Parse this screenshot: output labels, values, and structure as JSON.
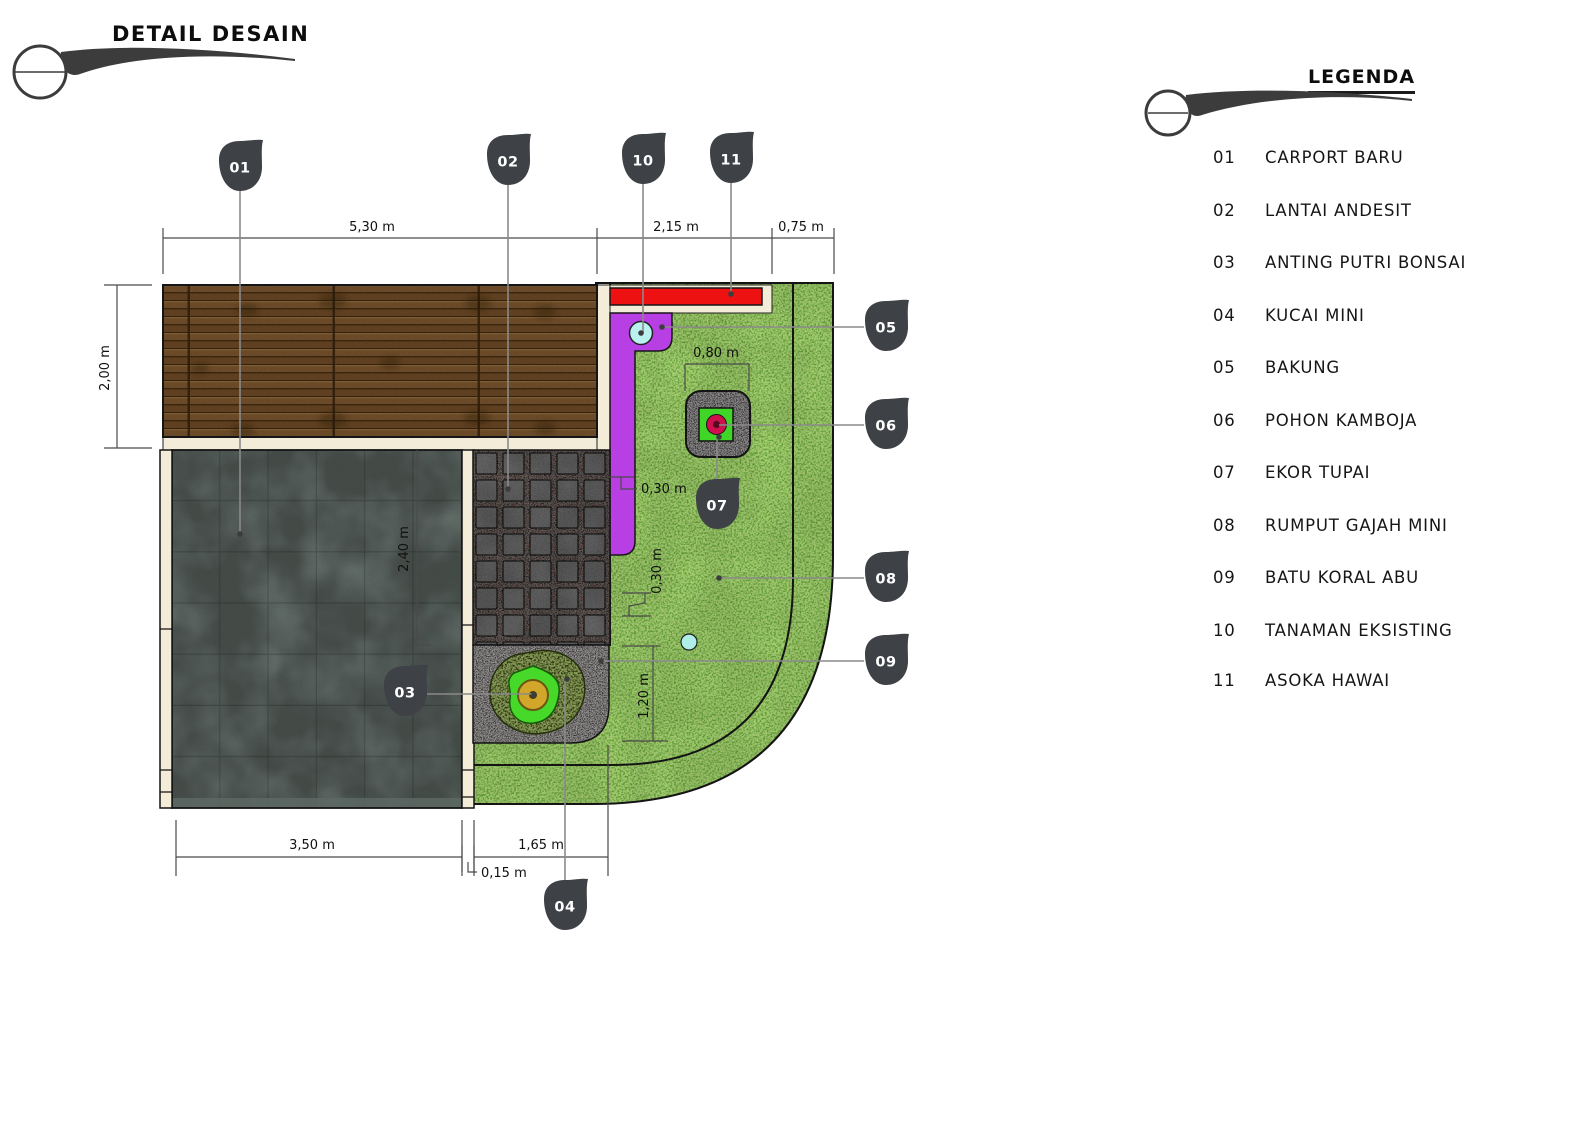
{
  "page": {
    "title": "DETAIL DESAIN"
  },
  "legend": {
    "title": "LEGENDA",
    "items": [
      {
        "num": "01",
        "label": "CARPORT BARU"
      },
      {
        "num": "02",
        "label": "LANTAI ANDESIT"
      },
      {
        "num": "03",
        "label": "ANTING PUTRI BONSAI"
      },
      {
        "num": "04",
        "label": "KUCAI MINI"
      },
      {
        "num": "05",
        "label": "BAKUNG"
      },
      {
        "num": "06",
        "label": "POHON KAMBOJA"
      },
      {
        "num": "07",
        "label": "EKOR TUPAI"
      },
      {
        "num": "08",
        "label": "RUMPUT GAJAH MINI"
      },
      {
        "num": "09",
        "label": "BATU KORAL ABU"
      },
      {
        "num": "10",
        "label": "TANAMAN EKSISTING"
      },
      {
        "num": "11",
        "label": "ASOKA HAWAI"
      }
    ]
  },
  "plan": {
    "dims": {
      "deck_width": "5,30 m",
      "asoka_width": "2,15 m",
      "side_width": "0,75 m",
      "deck_depth": "2,00 m",
      "carport_depth": "2,40 m",
      "bakung_strip_width": "0,30 m",
      "kamboja_bed_width": "0,80 m",
      "edge_strip_width": "0,30 m",
      "koral_bed_depth": "1,20 m",
      "carport_width": "3,50 m",
      "andesit_width": "1,65 m",
      "curb_width": "0,15 m"
    },
    "colors": {
      "grass": "#56a52d",
      "asoka_red": "#ee1111",
      "bakung_purple": "#b83fe3",
      "wood_deck": "#6f4a28",
      "carport_gray": "#6e7a75",
      "andesite_tile": "#5e5e5e",
      "koral_gray": "#6e6765",
      "cream_curb": "#f2ecd8",
      "callout_marker": "#3e4146",
      "kamboja_green": "#3fd627",
      "kamboja_flower": "#cf0f4e",
      "anting_green": "#47d929",
      "tanaman_cyan": "#b9f1ef"
    }
  }
}
